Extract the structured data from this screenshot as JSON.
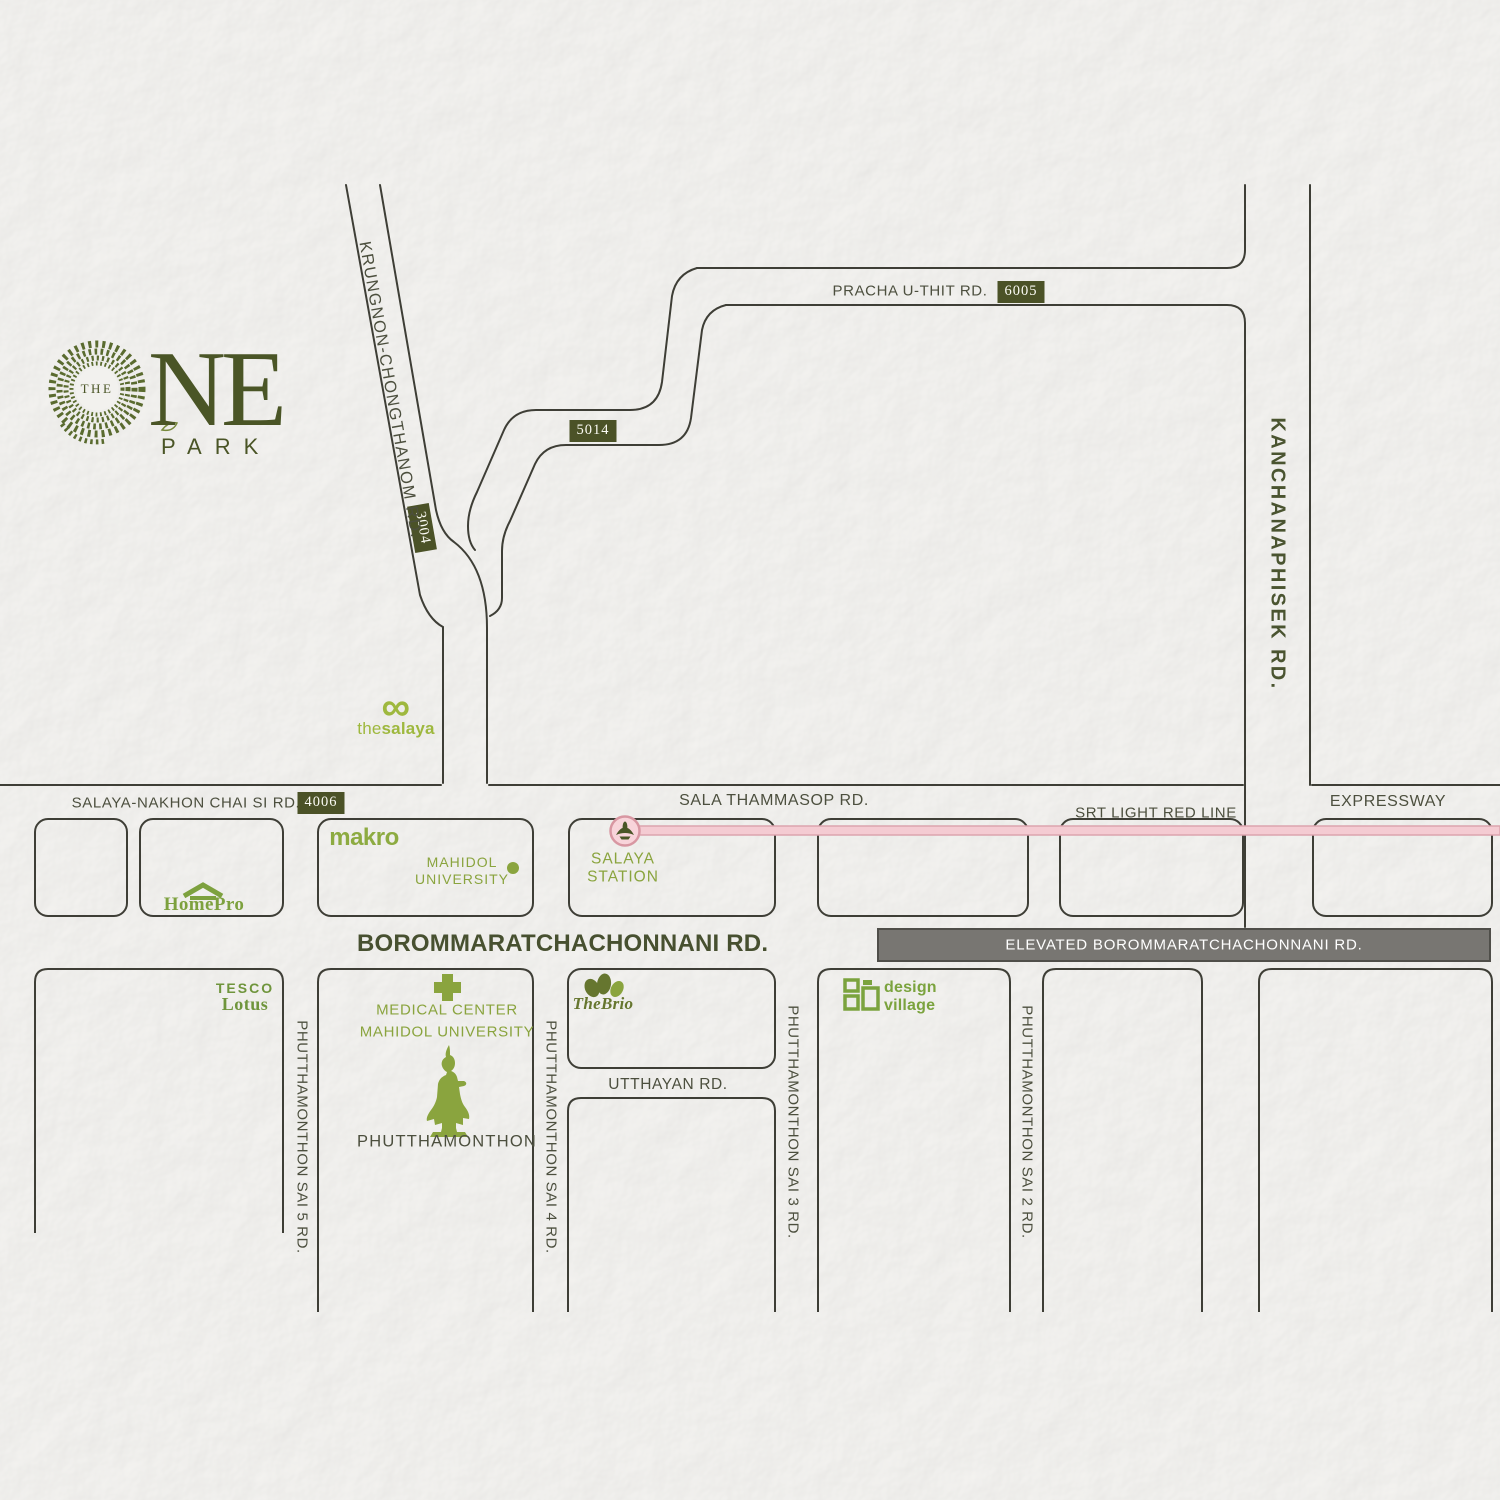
{
  "logo": {
    "the": "THE",
    "ne": "NE",
    "park": "PARK"
  },
  "badges": {
    "r6005": "6005",
    "r5014": "5014",
    "r3004": "3004",
    "r4006": "4006"
  },
  "roads": {
    "pracha_u_thit": "PRACHA U-THIT RD.",
    "krungnon_chongthanom": "KRUNGNON-CHONGTHANOM RD.",
    "kanchanaphisek": "KANCHANAPHISEK RD.",
    "salaya_nakhon_chai_si": "SALAYA-NAKHON CHAI SI RD.",
    "sala_thammasop": "SALA THAMMASOP RD.",
    "srt_light_red_line": "SRT LIGHT RED LINE",
    "expressway": "EXPRESSWAY",
    "borommaratchachonnani": "BOROMMARATCHACHONNANI RD.",
    "elevated_borommaratchachonnani": "ELEVATED BOROMMARATCHACHONNANI RD.",
    "utthayan": "UTTHAYAN RD.",
    "phutthamonthon_sai_5": "PHUTTHAMONTHON SAI 5 RD.",
    "phutthamonthon_sai_4": "PHUTTHAMONTHON SAI 4 RD.",
    "phutthamonthon_sai_3": "PHUTTHAMONTHON SAI 3 RD.",
    "phutthamonthon_sai_2": "PHUTTHAMONTHON SAI 2 RD."
  },
  "landmarks": {
    "the_salaya": {
      "infinity": "∞",
      "the": "the",
      "salaya": "salaya"
    },
    "makro": "makro",
    "mahidol_university": {
      "line1": "MAHIDOL",
      "line2": "UNIVERSITY"
    },
    "homepro": "HomePro",
    "salaya_station": {
      "line1": "SALAYA",
      "line2": "STATION"
    },
    "tesco_lotus": {
      "line1": "TESCO",
      "line2": "Lotus"
    },
    "medical_center": {
      "line1": "MEDICAL CENTER",
      "line2": "MAHIDOL UNIVERSITY"
    },
    "phutthamonthon": "PHUTTHAMONTHON",
    "the_brio": {
      "the": "The",
      "brio": "Brio"
    },
    "design_village": {
      "line1": "design",
      "line2": "village"
    }
  },
  "colors": {
    "paper": "#f0efed",
    "road_line": "#3e3e36",
    "label_dark": "#4c4f3e",
    "logo_olive": "#4a5526",
    "badge_olive": "#4b5227",
    "brand_green": "#8aa43e",
    "salaya_lime": "#9eb83e",
    "srt_pink": "#f4cbd2",
    "srt_pink_border": "#dca4ae",
    "elevated_gray": "#787672"
  }
}
